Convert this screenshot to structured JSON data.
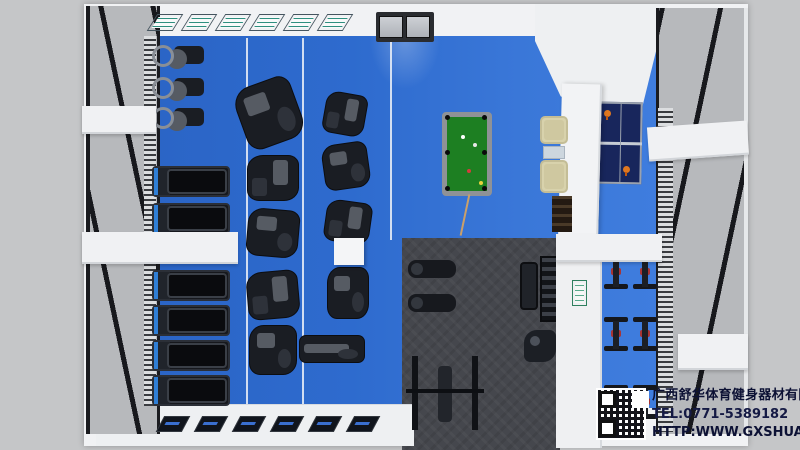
{
  "watermark": {
    "company": "广西舒华体育健身器材有限公司",
    "tel": "TEL:0771-5389182",
    "website": "HTTP:WWW.GXSHUA.COM"
  },
  "colors": {
    "background_gray": "#c5c6c8",
    "wall_white": "#f1f2f4",
    "floor_blue": "#2e6bce",
    "rubber_mat_gray": "#45474d",
    "pool_felt_green": "#1d7f22",
    "pingpong_navy": "#18265c",
    "sofa_beige": "#d8d2ac",
    "treadmill_accent_blue": "#2f7fd6",
    "spin_bike_accent_red": "#a83434",
    "watermark_text_navy": "#0c1134"
  },
  "icon_names": {
    "qr_code": "qr-code-icon",
    "equipment": [
      "elliptical-trainer",
      "treadmill",
      "strength-machine",
      "weight-bench",
      "squat-rack",
      "dumbbell-rack",
      "spin-bike",
      "pool-table",
      "ping-pong-table",
      "sofa"
    ]
  }
}
